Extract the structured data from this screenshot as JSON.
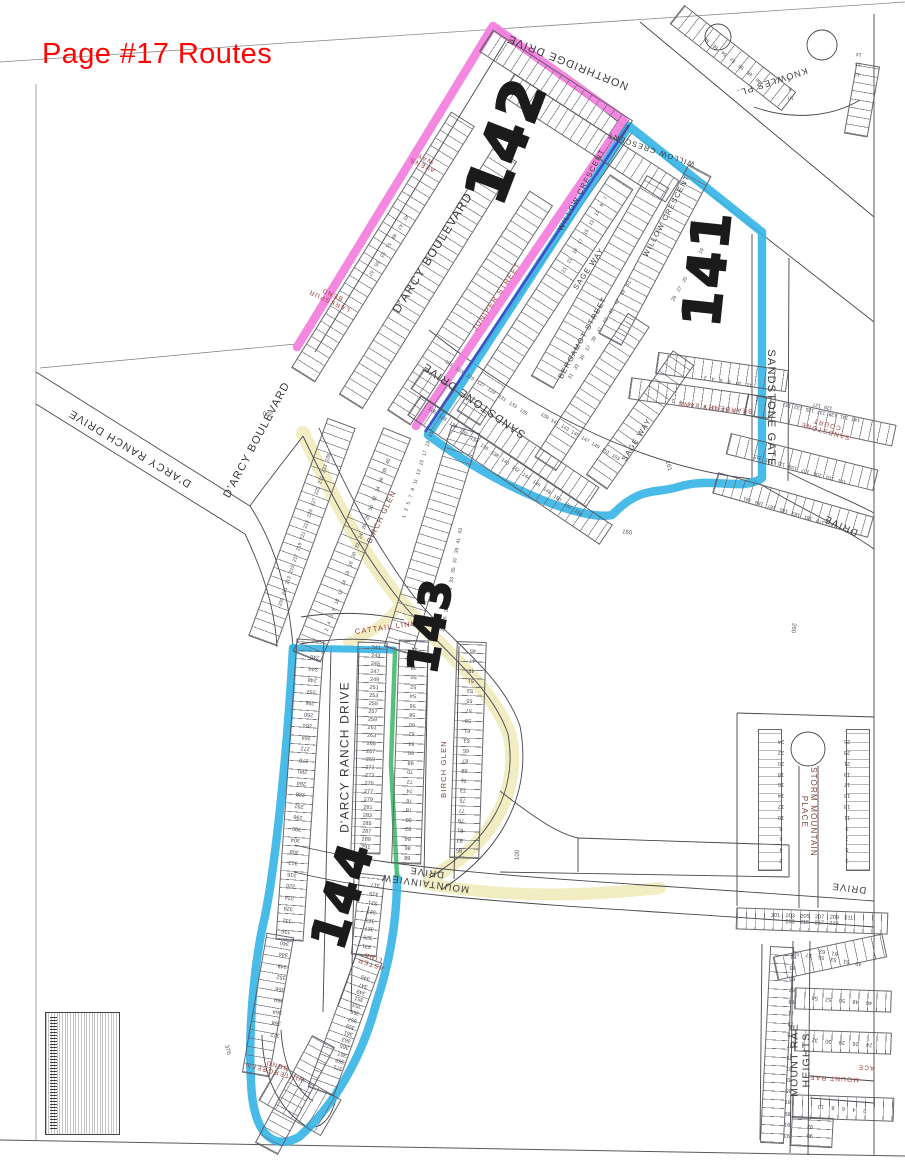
{
  "page_title": {
    "text": "Page #17 Routes"
  },
  "map": {
    "routes": [
      {
        "number": "142",
        "highlight_color": "#f37edd"
      },
      {
        "number": "141",
        "highlight_color": "#35b4e6"
      },
      {
        "number": "143",
        "highlight_color": "none"
      },
      {
        "number": "144",
        "highlight_color": "#35b4e6"
      }
    ],
    "colors": {
      "route_pink": "#f37edd",
      "route_blue": "#35b4e6",
      "route_blue_dark": "#3f51c9",
      "route_green": "#44ba6e",
      "road_yellow": "#f2ecc0",
      "title_red": "#fe0505",
      "street_label_red": "#a0403a"
    },
    "street_labels": [
      {
        "text": "NORTHRIDGE DRIVE"
      },
      {
        "text": "KNOWLES PL."
      },
      {
        "text": "D'ARCY BOULEVARD"
      },
      {
        "text": "AVENS\nWAY"
      },
      {
        "text": "LARKSPUR\nBEND"
      },
      {
        "text": "WILLOW CRESCENT"
      },
      {
        "text": "WILLOW CRESCENT"
      },
      {
        "text": "WILLOW CRESCENT"
      },
      {
        "text": "SAGE WAY"
      },
      {
        "text": "BERGAMOT STREET"
      },
      {
        "text": "JUNIPER STREET"
      },
      {
        "text": "SANDSTONE DRIVE"
      },
      {
        "text": "SANDSTONE GATE"
      },
      {
        "text": "BEARBERRY LANE"
      },
      {
        "text": "SANDSTONE COURT"
      },
      {
        "text": "DRIVE"
      },
      {
        "text": "SAGE WAY"
      },
      {
        "text": "D'ARCY RANCH DRIVE"
      },
      {
        "text": "D'ARCY BOULEVARD"
      },
      {
        "text": "D'ARCY RANCH DRIVE"
      },
      {
        "text": "BIRCH GLEN"
      },
      {
        "text": "BIRCH GLEN"
      },
      {
        "text": "CATTAIL LINK"
      },
      {
        "text": "MOUNTAINVIEW\nDRIVE"
      },
      {
        "text": "ASTER\nLINK"
      },
      {
        "text": "WINTERGREEN\nBEND"
      },
      {
        "text": "STORM MOUNTAIN PLACE"
      },
      {
        "text": "DRIVE"
      },
      {
        "text": "MOUNT RAE HEIGHTS"
      },
      {
        "text": "MOUNT RAE"
      },
      {
        "text": "ACE"
      }
    ],
    "lot_numbers": {
      "darcy_ranch_west": "372\n368\n364\n360\n356\n352\n348\n344\n340\n336\n332\n328\n324\n320\n316\n312\n308\n304\n300\n296\n292\n288\n284\n280\n276\n272\n268\n264\n260\n256\n252\n248\n244\n240",
      "darcy_ranch_east": "241\n243\n245\n247\n249\n251\n253\n255\n257\n259\n261\n263\n265\n267\n269\n271\n273\n275\n277\n279\n281\n283\n285\n287\n289\n291",
      "birch_glen_west": "88\n86\n84\n82\n80\n78\n76\n74\n72\n70\n68\n66\n64\n62\n60\n58\n56\n54\n52\n50\n48\n46\n44",
      "birch_glen_east": "85\n83\n81\n79\n77\n75\n73\n71\n69\n67\n65\n63\n61\n59\n57\n55\n53\n51\n49\n47\n45",
      "aster_west": "331\n329\n327\n325\n323\n321\n319\n317",
      "aster_east": "371\n369\n367\n365\n363\n361\n359\n357\n355\n353\n351\n349\n347\n345",
      "storm_west": "2\n4\n6\n8\n10\n12\n14\n16\n18\n20\n22\n24",
      "storm_east": "3\n5\n7\n9\n11\n13\n15\n17\n19\n21\n23\n25",
      "storm_bottom": "201 203 205 207 209 211 213 215 217 219",
      "mount_rae_west": "93\n91\n89\n87\n85\n83\n81\n79\n77\n75\n73\n71\n69\n67\n65\n63\n61",
      "mount_rae_top": "49 51 53 55 57 59 61 63",
      "mount_rae_mid1": "46 48 50 52 54",
      "mount_rae_mid2": "24 26 28 30 32",
      "mount_rae_low": "2 4 6 8 10",
      "mount_rae_low2": "90\n92",
      "sandstone_south": "126 128 130 132 134 136 138 140 142 144 146 148 150 152 154",
      "sandstone_north": "121 123 125 127 129 131 133 135",
      "bergamot": "139 141 143 145 147 149 151 153",
      "sandstone_court_top": "143 141 139 137 135 133 131 129 127",
      "sandstone_court_mid": "101 103 105 107 109 111 113 115",
      "sandstone_court_bot": "177 179 181 183 185 187 189 191",
      "willow_west": "23 21 19 17 15 13 11 9 7",
      "sage_row": "31 33 35 37 39 41 43 45 47 49 51",
      "willow_east": "29 27 25 23 21 19",
      "bearberry_north": "12 10 8 6 4 2",
      "bearberry_south": "15 13 11 9 7 5 3 1",
      "upper_birch_east1": "1 3 5 7 9 11 13 15 17 19 21",
      "upper_birch_east2": "23 25 27 29 31 33 35 37 39 41 43",
      "upper_birch_west": "2 4 6 8 10 12 14 16 18 20 22 24 26 28 30 32 34 36 38 40",
      "arc_lots": "209 211 213 215 217 219 221 223 225 227 229 231 233 235",
      "knowles_diag": "46 48 50 52 54 56 58",
      "knowles_left": "10\n8\n6",
      "knowles_right": "12\n13\n14",
      "route142_strip": "45 47 49 51 53 55 57"
    },
    "parcel_labels": [
      {
        "text": "200"
      },
      {
        "text": "260"
      },
      {
        "text": "376"
      },
      {
        "text": "100"
      },
      {
        "text": "160"
      },
      {
        "text": "161"
      }
    ]
  }
}
